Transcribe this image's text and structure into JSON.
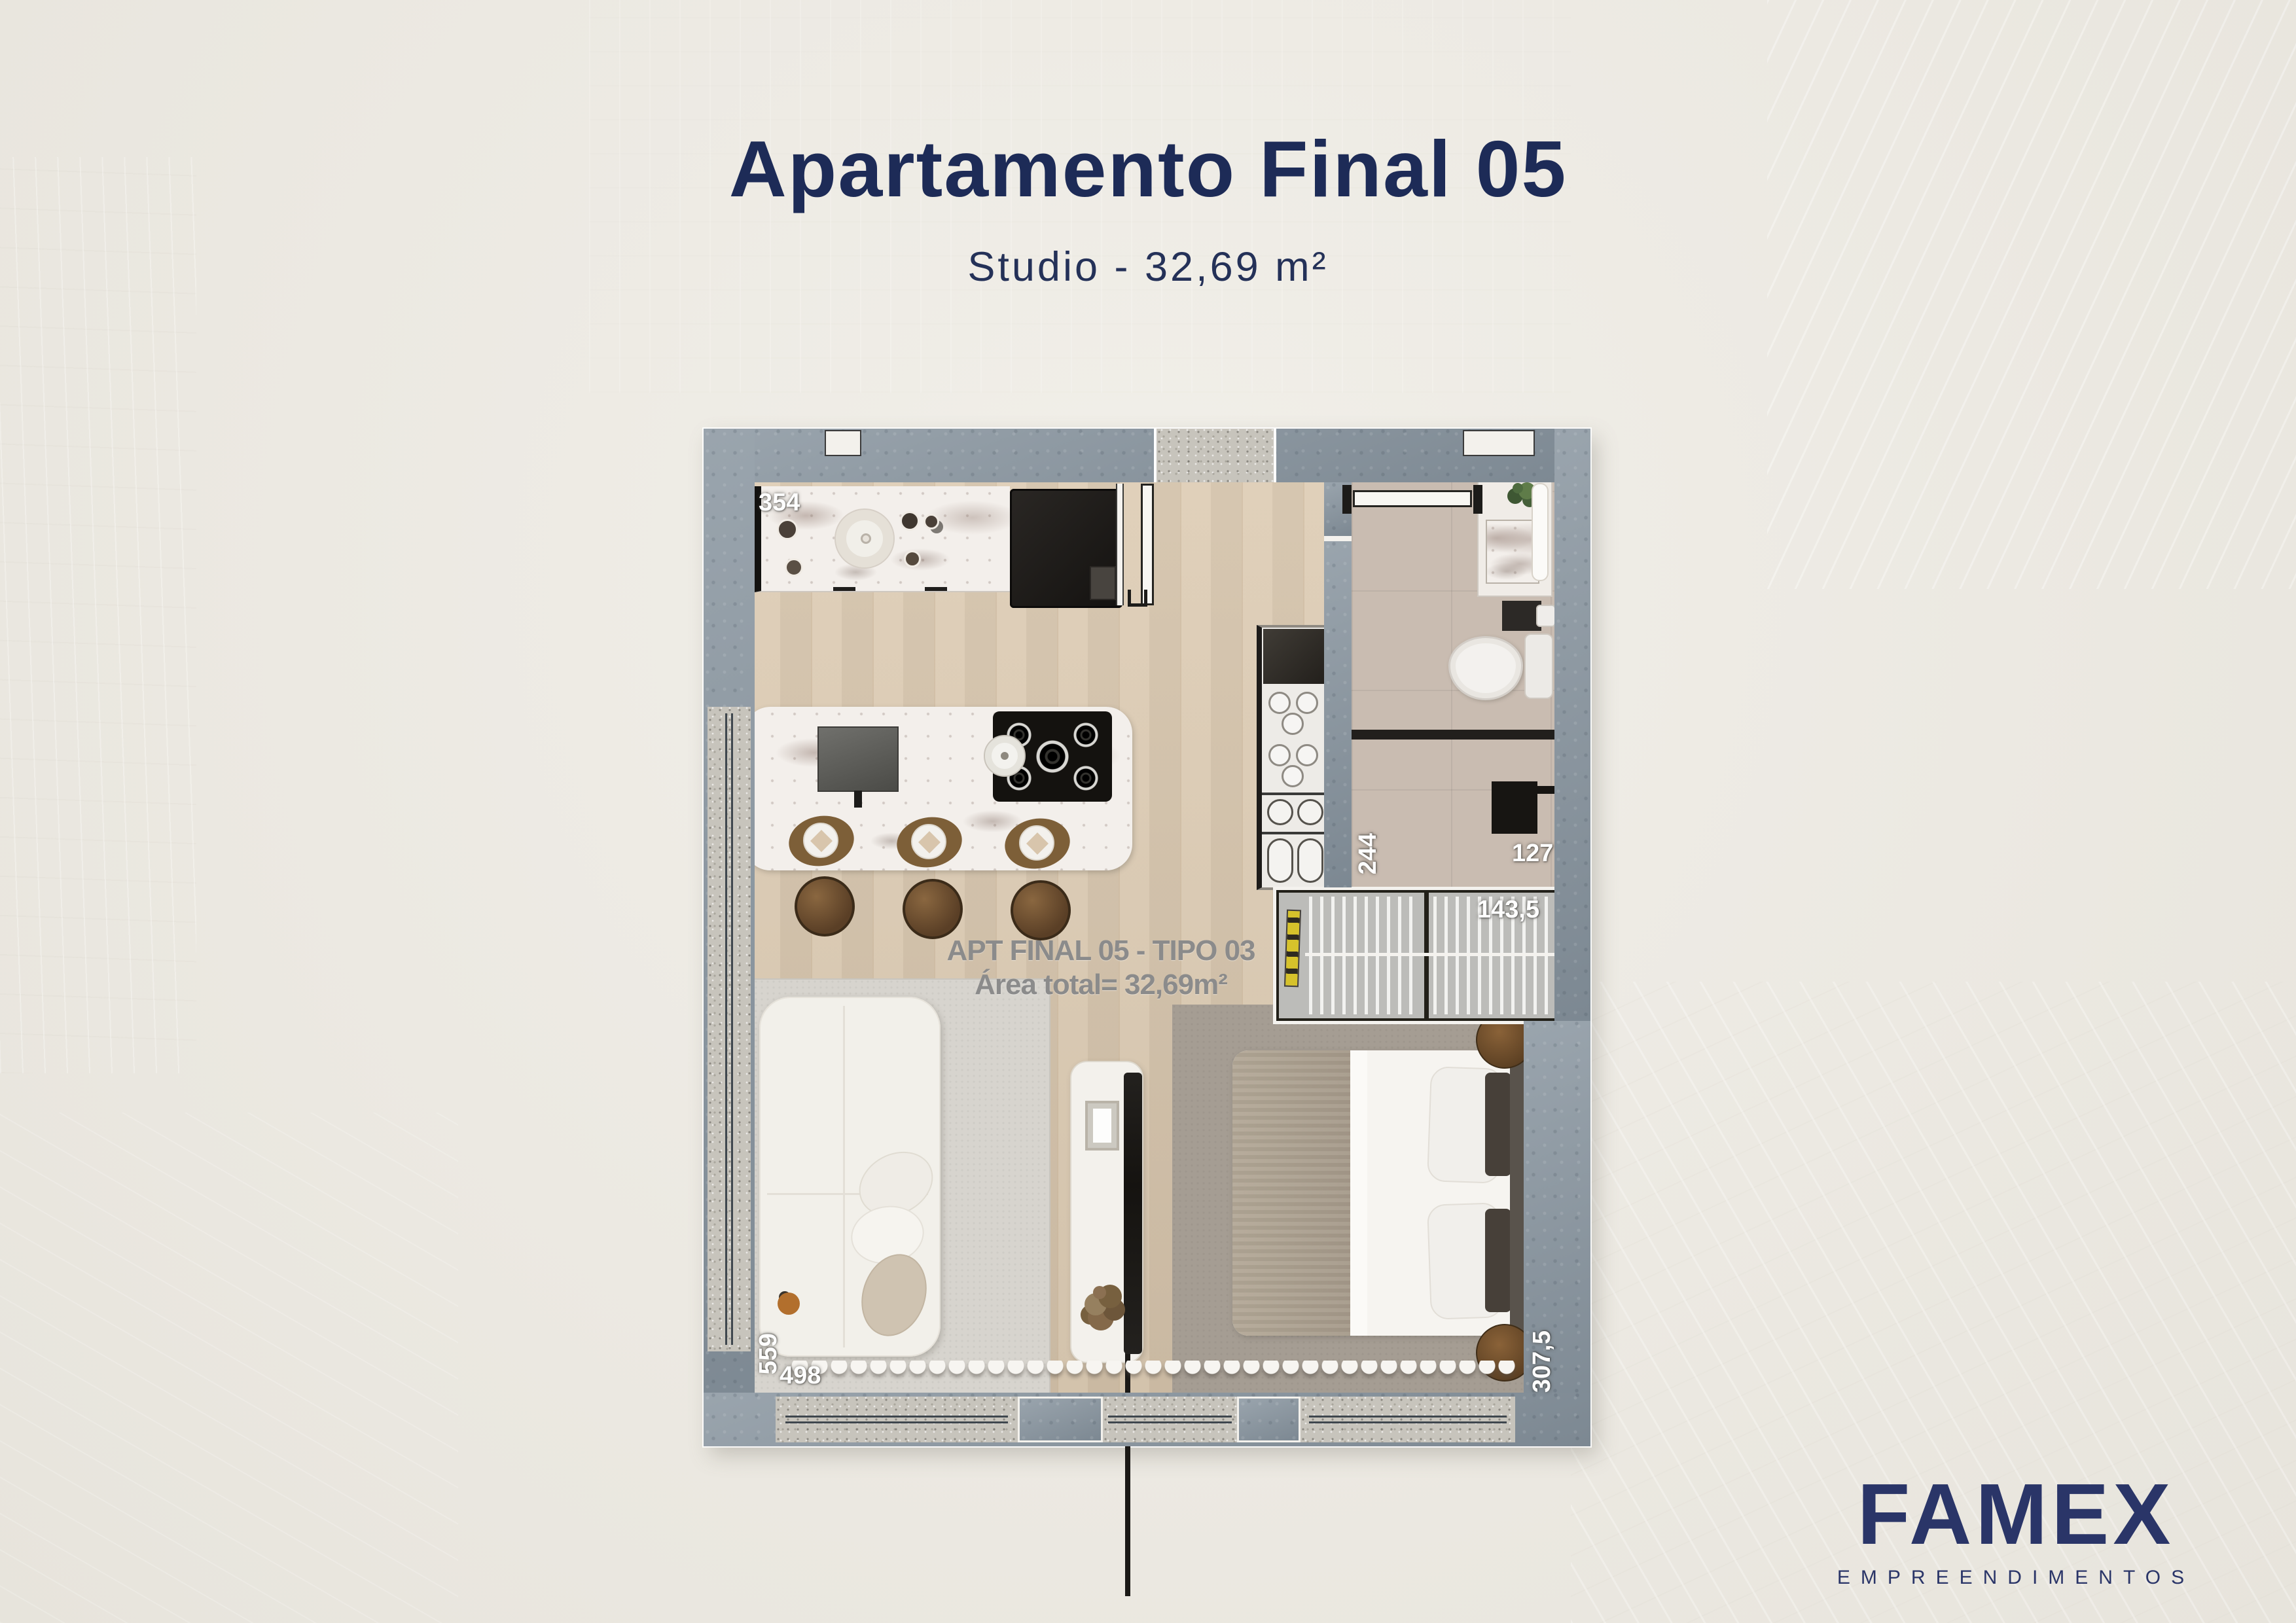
{
  "header": {
    "title": "Apartamento Final 05",
    "subtitle": "Studio - 32,69 m²"
  },
  "floorplan": {
    "unit_label": "APT FINAL 05 - TIPO 03",
    "area_label": "Área total= 32,69m²",
    "dimensions": {
      "kitchen_counter": "354",
      "bathroom_length": "244",
      "bathroom_width": "127",
      "wardrobe_width": "143,5",
      "living_length": "559",
      "living_width": "498",
      "bedroom_length": "307,5"
    }
  },
  "brand": {
    "name": "FAMEX",
    "tagline": "EMPREENDIMENTOS"
  },
  "colors": {
    "navy": "#1d2b57",
    "logo_navy": "#2a3568",
    "wall": "#8c98a2",
    "floor_wood": "#dccab1",
    "label_gray": "#8b8b8b",
    "label_white": "#ffffff"
  }
}
